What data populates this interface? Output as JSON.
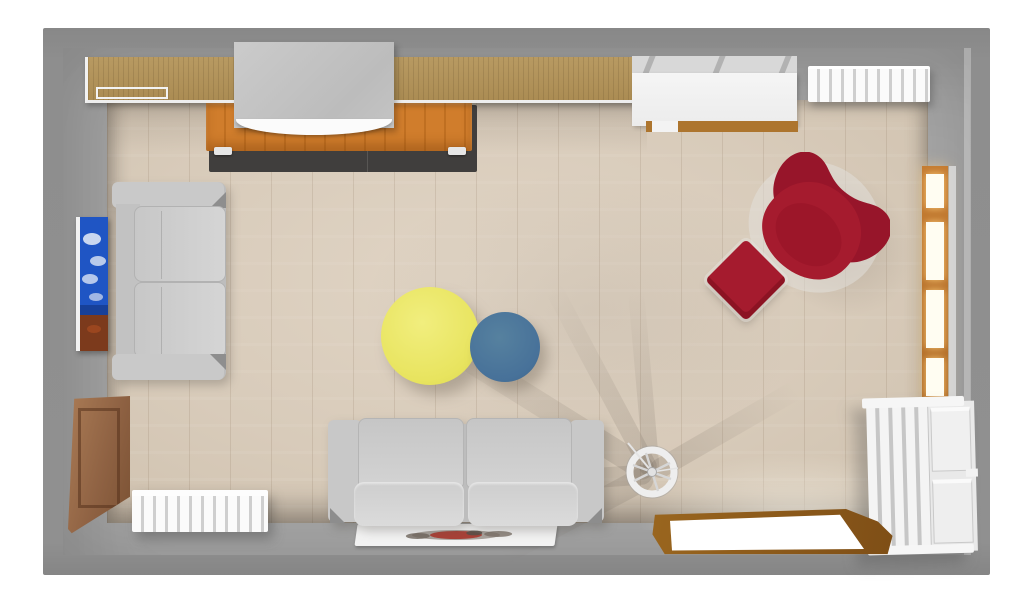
{
  "app": {
    "title": "3D top-down render of a furnished living room",
    "view": "top view"
  },
  "palette": {
    "background": "#ffffff",
    "wall_outer": "#8c8c8c",
    "wall_face": "#a4a4a4",
    "floor_wood": "#d8cbba",
    "shelf_wood": "#b2955e",
    "sideboard_orange": "#cf7c2b",
    "rug_dark": "#403e3d",
    "tv_gray": "#c4c4c4",
    "cabinet_white": "#f2f2f2",
    "radiator_white": "#fbfbfb",
    "window_frame_wood": "#c57c32",
    "window_glow": "#fffdf2",
    "sofa_gray": "#cccccc",
    "table_yellow": "#e8e45f",
    "table_blue": "#477199",
    "chair_red": "#a51b2e",
    "ottoman_red": "#a51b2e",
    "painting_blue": "#1f55c4",
    "door_wood": "#8a5a22",
    "mat_white": "#f2f2f2",
    "kallax_white": "#e9e9e9",
    "panel_wood": "#996b48"
  },
  "scene": {
    "items": [
      {
        "name": "armchair-red",
        "label": "Red wing armchair",
        "color": "#a51b2e",
        "position": "right-center, rotated 45°"
      },
      {
        "name": "ottoman-red",
        "label": "Red square ottoman",
        "color": "#a51b2e",
        "position": "left of armchair, rotated 45°"
      },
      {
        "name": "coffee-table-yellow",
        "label": "Yellow round coffee table",
        "color": "#e8e45f",
        "position": "room center"
      },
      {
        "name": "coffee-table-blue",
        "label": "Blue round coffee table",
        "color": "#477199",
        "position": "room center, overlapping yellow table"
      },
      {
        "name": "sofa-bottom",
        "label": "Gray two-seat sofa",
        "color": "#cccccc",
        "position": "bottom wall"
      },
      {
        "name": "sofa-left",
        "label": "Gray two-seat sofa",
        "color": "#cccccc",
        "position": "left wall"
      },
      {
        "name": "wall-shelf",
        "label": "Wood wall shelf with white trim",
        "color": "#b2955e",
        "position": "top wall"
      },
      {
        "name": "tv-screen-box",
        "label": "Gray cabinet / screen box",
        "color": "#c4c4c4",
        "position": "top wall on sideboard"
      },
      {
        "name": "media-sideboard",
        "label": "Orange media sideboard",
        "color": "#cf7c2b",
        "position": "top wall"
      },
      {
        "name": "dark-rug",
        "label": "Dark gray rug",
        "color": "#403e3d",
        "position": "under sideboard"
      },
      {
        "name": "white-sideboard",
        "label": "White sideboard",
        "color": "#f2f2f2",
        "position": "top wall right"
      },
      {
        "name": "radiator-top-right",
        "label": "White finned radiator",
        "color": "#fbfbfb",
        "position": "top-right corner"
      },
      {
        "name": "window-right",
        "label": "Window with wood frame",
        "color": "#c57c32",
        "position": "right wall"
      },
      {
        "name": "cube-shelving",
        "label": "White cube shelving unit",
        "color": "#e9e9e9",
        "position": "bottom-right along right wall"
      },
      {
        "name": "doorway",
        "label": "Open doorway with wood frame",
        "color": "#8a5a22",
        "position": "bottom wall right"
      },
      {
        "name": "white-mat",
        "label": "White mat with printed design",
        "color": "#f2f2f2",
        "position": "below bottom sofa"
      },
      {
        "name": "radiator-bottom-left",
        "label": "White finned radiator",
        "color": "#fbfbfb",
        "position": "bottom-left"
      },
      {
        "name": "wood-wall-panel",
        "label": "Wood wall panel",
        "color": "#996b48",
        "position": "left wall bottom"
      },
      {
        "name": "painting",
        "label": "Blue painting on canvas",
        "color": "#1f55c4",
        "position": "left wall"
      },
      {
        "name": "spinning-wheel",
        "label": "White spoked wheel decor",
        "color": "#ececec",
        "position": "floor near doorway"
      }
    ]
  }
}
